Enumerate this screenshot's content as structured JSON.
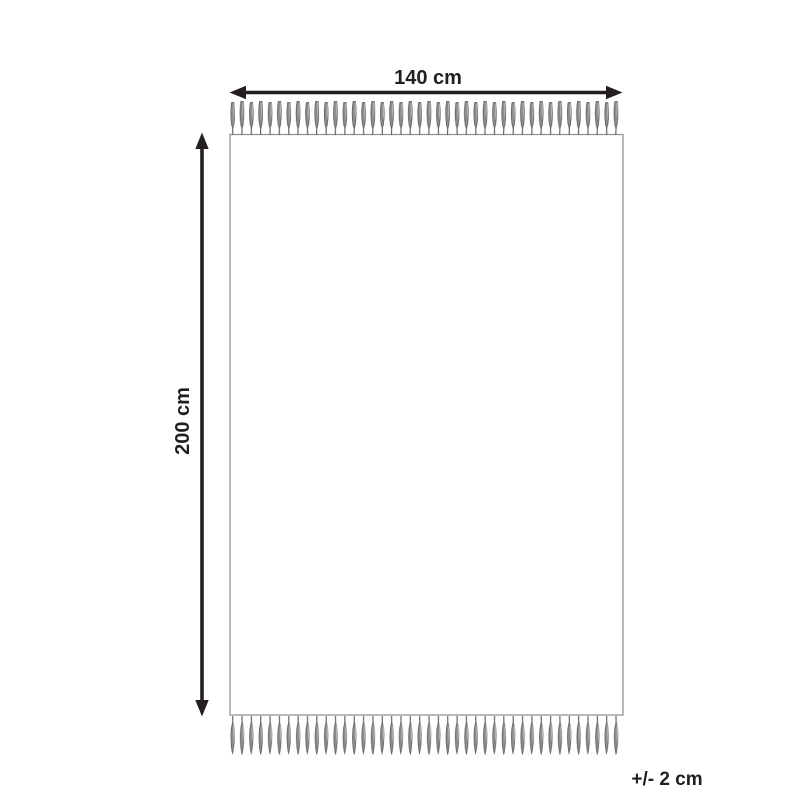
{
  "diagram": {
    "type": "product-dimension-diagram",
    "subject": "fringed rug top view",
    "width_label": "140 cm",
    "height_label": "200 cm",
    "tolerance_label": "+/- 2 cm"
  },
  "colors": {
    "ink": "#231f20",
    "rug-border": "#939598",
    "rug-fill": "#ffffff",
    "fringe-dark": "#58595b",
    "fringe-mid": "#8a8c8e",
    "fringe-light": "#b7b9bb",
    "background": "#ffffff"
  }
}
